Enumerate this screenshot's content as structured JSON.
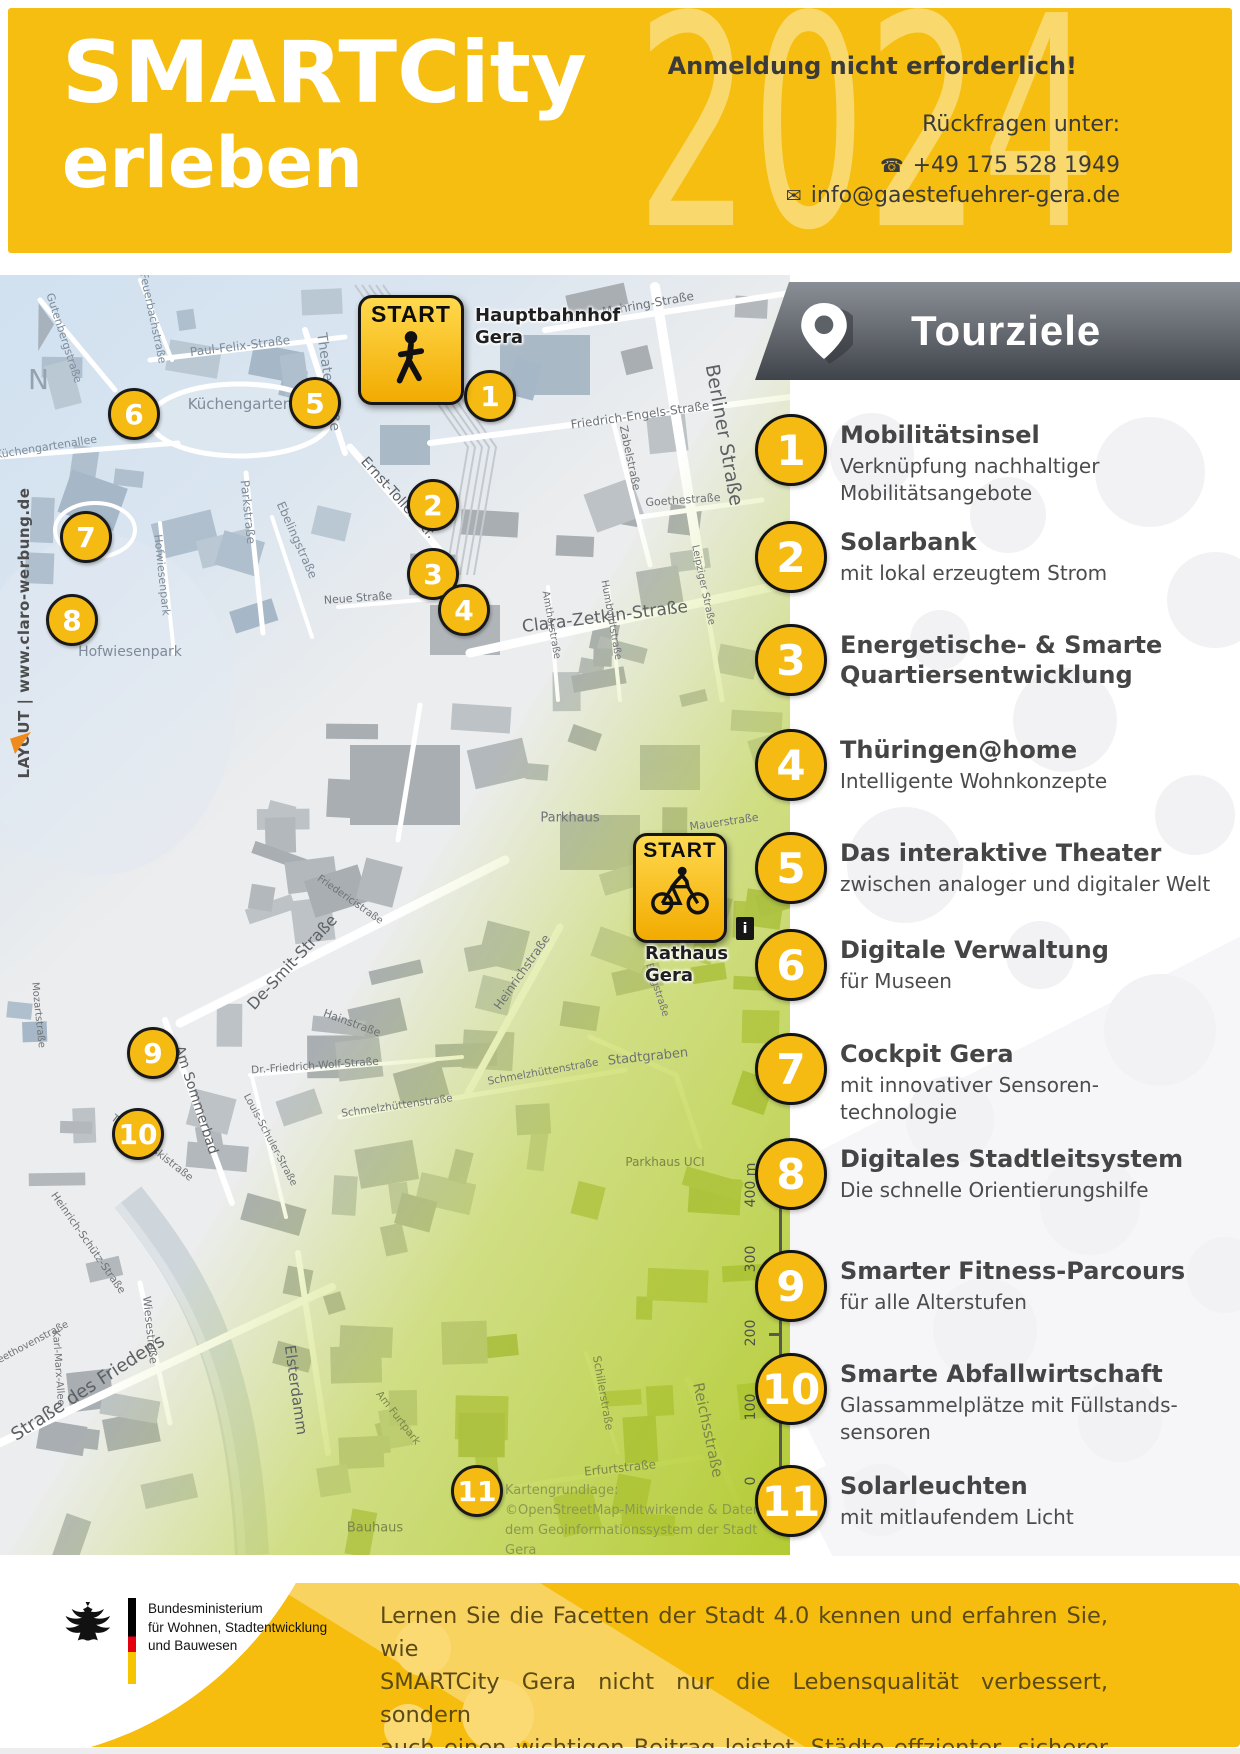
{
  "header": {
    "title_line1": "SMARTCity",
    "title_line2": "erleben",
    "year_watermark": "2024",
    "note": "Anmeldung nicht erforderlich!",
    "contact_label": "Rückfragen unter:",
    "phone": "+49 175 528 1949",
    "email": "info@gaestefuehrer-gera.de",
    "phone_icon": "☎",
    "email_icon": "✉",
    "background_color": "#f6be10"
  },
  "map": {
    "north_label": "N",
    "layout_credit": "LAYOUT | www.claro-werbung.de",
    "start_walk": {
      "badge": "START",
      "place": "Hauptbahnhof\nGera"
    },
    "start_bike": {
      "badge": "START",
      "place": "Rathaus\nGera"
    },
    "info_label": "i",
    "scale_labels": [
      "400 m",
      "300",
      "200",
      "100",
      "0"
    ],
    "attribution": [
      "Kartengrundlage:",
      "©OpenStreetMap-Mitwirkende & Daten aus",
      "dem Geoinformationssystem der Stadt Gera"
    ],
    "markers": [
      {
        "n": "1",
        "x": 490,
        "y": 121
      },
      {
        "n": "2",
        "x": 433,
        "y": 230
      },
      {
        "n": "3",
        "x": 433,
        "y": 299
      },
      {
        "n": "4",
        "x": 464,
        "y": 335
      },
      {
        "n": "5",
        "x": 315,
        "y": 128
      },
      {
        "n": "6",
        "x": 134,
        "y": 139
      },
      {
        "n": "7",
        "x": 86,
        "y": 262
      },
      {
        "n": "8",
        "x": 72,
        "y": 345
      },
      {
        "n": "9",
        "x": 153,
        "y": 778
      },
      {
        "n": "10",
        "x": 138,
        "y": 859
      },
      {
        "n": "11",
        "x": 477,
        "y": 1216
      }
    ],
    "street_labels": [
      {
        "t": "Gutenbergstraße",
        "x": 64,
        "y": 63,
        "r": 72,
        "s": 11,
        "c": "b"
      },
      {
        "t": "Feuerbachstraße",
        "x": 153,
        "y": 43,
        "r": 78,
        "s": 11,
        "c": "b"
      },
      {
        "t": "Paul-Felix-Straße",
        "x": 240,
        "y": 71,
        "r": -7,
        "s": 12,
        "c": "b"
      },
      {
        "t": "Theaterstraße",
        "x": 328,
        "y": 107,
        "r": 82,
        "s": 14,
        "c": "b"
      },
      {
        "t": "Küchengarten",
        "x": 240,
        "y": 129,
        "r": 0,
        "s": 15,
        "c": "b"
      },
      {
        "t": "Küchengartenallee",
        "x": 46,
        "y": 172,
        "r": -9,
        "s": 11,
        "c": "b"
      },
      {
        "t": "Franz-Mehring-Straße",
        "x": 630,
        "y": 32,
        "r": -10,
        "s": 12,
        "c": ""
      },
      {
        "t": "Friedrich-Engels-Straße",
        "x": 640,
        "y": 140,
        "r": -8,
        "s": 12,
        "c": ""
      },
      {
        "t": "Zabelstraße",
        "x": 630,
        "y": 183,
        "r": 78,
        "s": 11,
        "c": ""
      },
      {
        "t": "Goethestraße",
        "x": 683,
        "y": 225,
        "r": -4,
        "s": 11,
        "c": ""
      },
      {
        "t": "Berliner Straße",
        "x": 724,
        "y": 160,
        "r": 80,
        "s": 19,
        "c": "dk"
      },
      {
        "t": "Ernst-Toller-Str.",
        "x": 398,
        "y": 223,
        "r": 48,
        "s": 14,
        "c": "dk"
      },
      {
        "t": "Clara-Zetkin-Straße",
        "x": 605,
        "y": 342,
        "r": -7,
        "s": 17,
        "c": "dk"
      },
      {
        "t": "Amthorstraße",
        "x": 551,
        "y": 350,
        "r": 80,
        "s": 10,
        "c": ""
      },
      {
        "t": "Humboldtstraße",
        "x": 611,
        "y": 345,
        "r": 80,
        "s": 10,
        "c": ""
      },
      {
        "t": "Leipziger Straße",
        "x": 703,
        "y": 310,
        "r": 78,
        "s": 10,
        "c": ""
      },
      {
        "t": "Neue Straße",
        "x": 358,
        "y": 323,
        "r": -4,
        "s": 11,
        "c": ""
      },
      {
        "t": "Parkstraße",
        "x": 248,
        "y": 237,
        "r": 84,
        "s": 12,
        "c": "b"
      },
      {
        "t": "Ebelingstraße",
        "x": 297,
        "y": 265,
        "r": 66,
        "s": 12,
        "c": "b"
      },
      {
        "t": "Hofwiesenpark",
        "x": 162,
        "y": 300,
        "r": 84,
        "s": 11,
        "c": "b"
      },
      {
        "t": "Hofwiesenpark",
        "x": 130,
        "y": 377,
        "r": 0,
        "s": 14,
        "c": "b"
      },
      {
        "t": "De-Smit-Straße",
        "x": 292,
        "y": 687,
        "r": -47,
        "s": 16,
        "c": "dk"
      },
      {
        "t": "Friedericistraße",
        "x": 350,
        "y": 625,
        "r": 35,
        "s": 10,
        "c": ""
      },
      {
        "t": "Hainstraße",
        "x": 352,
        "y": 748,
        "r": 20,
        "s": 11,
        "c": ""
      },
      {
        "t": "Dr.-Friedrich-Wolf-Straße",
        "x": 315,
        "y": 791,
        "r": -4,
        "s": 10.5,
        "c": ""
      },
      {
        "t": "Louis-Schuler-Straße",
        "x": 270,
        "y": 865,
        "r": 62,
        "s": 10,
        "c": ""
      },
      {
        "t": "Am Sommerbad",
        "x": 196,
        "y": 825,
        "r": 72,
        "s": 14,
        "c": "dk"
      },
      {
        "t": "Tschaikowskistraße",
        "x": 152,
        "y": 873,
        "r": 38,
        "s": 10.5,
        "c": ""
      },
      {
        "t": "Heinrichstraße",
        "x": 522,
        "y": 697,
        "r": -55,
        "s": 12,
        "c": ""
      },
      {
        "t": "Parkhaus",
        "x": 570,
        "y": 543,
        "r": 0,
        "s": 13,
        "c": ""
      },
      {
        "t": "Mauerstraße",
        "x": 724,
        "y": 547,
        "r": -8,
        "s": 11,
        "c": ""
      },
      {
        "t": "Burgstraße",
        "x": 657,
        "y": 715,
        "r": 72,
        "s": 10,
        "c": ""
      },
      {
        "t": "Stadtgraben",
        "x": 648,
        "y": 782,
        "r": -6,
        "s": 13,
        "c": ""
      },
      {
        "t": "Parkhaus UCI",
        "x": 665,
        "y": 887,
        "r": 0,
        "s": 12,
        "c": "g"
      },
      {
        "t": "Schmelzhüttenstraße",
        "x": 543,
        "y": 797,
        "r": -10,
        "s": 10.5,
        "c": ""
      },
      {
        "t": "Schmelzhüttenstraße",
        "x": 397,
        "y": 831,
        "r": -8,
        "s": 10.5,
        "c": ""
      },
      {
        "t": "Straße des Friedens",
        "x": 88,
        "y": 1113,
        "r": -33,
        "s": 18,
        "c": "dk"
      },
      {
        "t": "Beethovenstraße",
        "x": 30,
        "y": 1069,
        "r": -28,
        "s": 10,
        "c": ""
      },
      {
        "t": "Heinrich-Schütz-Straße",
        "x": 88,
        "y": 968,
        "r": 55,
        "s": 10.5,
        "c": ""
      },
      {
        "t": "Wiesestraße",
        "x": 150,
        "y": 1055,
        "r": 84,
        "s": 11,
        "c": ""
      },
      {
        "t": "Karl-Marx-Allee",
        "x": 58,
        "y": 1093,
        "r": 86,
        "s": 10,
        "c": ""
      },
      {
        "t": "Elsterdamm",
        "x": 296,
        "y": 1115,
        "r": 82,
        "s": 15,
        "c": "dk"
      },
      {
        "t": "Am Furtpark",
        "x": 398,
        "y": 1143,
        "r": 52,
        "s": 10.5,
        "c": "g"
      },
      {
        "t": "Erfurtstraße",
        "x": 620,
        "y": 1193,
        "r": -6,
        "s": 12,
        "c": "g"
      },
      {
        "t": "Reichsstraße",
        "x": 708,
        "y": 1155,
        "r": 78,
        "s": 15,
        "c": "g"
      },
      {
        "t": "Schillerstraße",
        "x": 603,
        "y": 1118,
        "r": 80,
        "s": 11,
        "c": "g"
      },
      {
        "t": "Mozartstraße",
        "x": 38,
        "y": 740,
        "r": 84,
        "s": 10,
        "c": ""
      },
      {
        "t": "Bauhaus",
        "x": 375,
        "y": 1253,
        "r": 0,
        "s": 13,
        "c": "g"
      }
    ]
  },
  "tour": {
    "heading": "Tourziele",
    "accent_color": "#f5bb13",
    "items": [
      {
        "number": "1",
        "title": "Mobilitätsinsel",
        "subtitle": "Verknüpfung nachhaltiger\nMobilitätsangebote",
        "y": 447
      },
      {
        "number": "2",
        "title": "Solarbank",
        "subtitle": "mit lokal erzeugtem Strom",
        "y": 554
      },
      {
        "number": "3",
        "title": "Energetische- & Smarte\nQuartiersentwicklung",
        "subtitle": "",
        "y": 657
      },
      {
        "number": "4",
        "title": "Thüringen@home",
        "subtitle": "Intelligente Wohnkonzepte",
        "y": 762
      },
      {
        "number": "5",
        "title": "Das interaktive Theater",
        "subtitle": "zwischen analoger und digitaler Welt",
        "y": 865
      },
      {
        "number": "6",
        "title": "Digitale Verwaltung",
        "subtitle": "für Museen",
        "y": 962
      },
      {
        "number": "7",
        "title": "Cockpit Gera",
        "subtitle": "mit innovativer Sensoren-\ntechnologie",
        "y": 1066
      },
      {
        "number": "8",
        "title": "Digitales Stadtleitsystem",
        "subtitle": "Die schnelle Orientierungshilfe",
        "y": 1171
      },
      {
        "number": "9",
        "title": "Smarter Fitness-Parcours",
        "subtitle": "für alle Alterstufen",
        "y": 1283
      },
      {
        "number": "10",
        "title": "Smarte Abfallwirtschaft",
        "subtitle": "Glassammelplätze mit Füllstands-\nsensoren",
        "y": 1386
      },
      {
        "number": "11",
        "title": "Solarleuchten",
        "subtitle": "mit mitlaufendem Licht",
        "y": 1498
      }
    ]
  },
  "footer": {
    "ministry": [
      "Bundesministerium",
      "für Wohnen, Stadtentwicklung",
      "und Bauwesen"
    ],
    "message": [
      "Lernen Sie die Facetten der Stadt 4.0 kennen und erfahren Sie, wie",
      "SMARTCity Gera nicht nur die Lebensqualität verbessert, sondern",
      "auch einen wichtigen Beitrag leistet, Städte effzienter, sicherer und",
      "umweltfreundlicher zu gestalten."
    ],
    "background_color": "#f6bd0e"
  }
}
